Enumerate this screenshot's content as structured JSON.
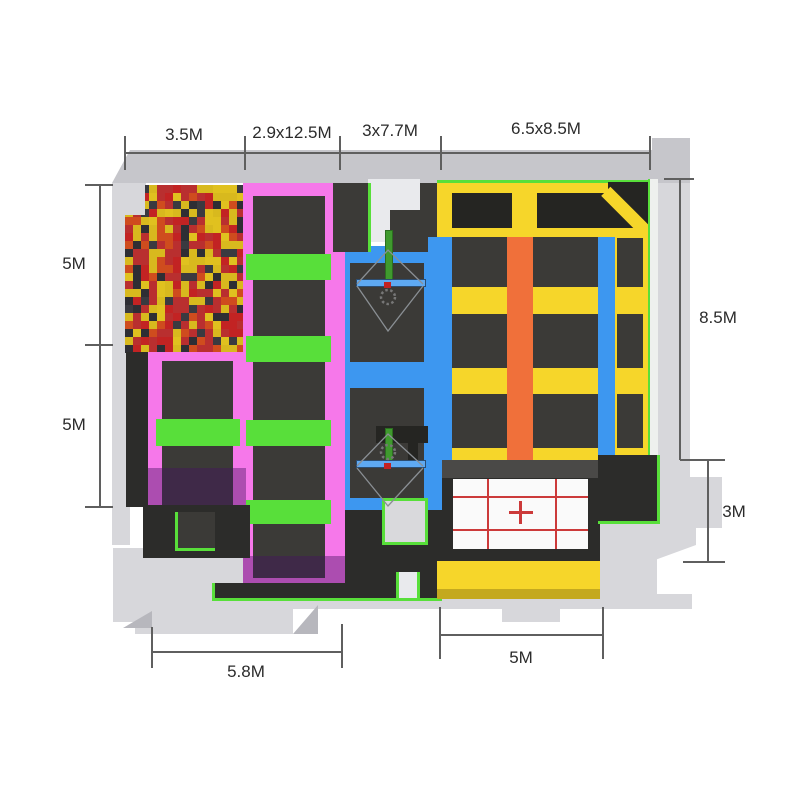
{
  "dims": {
    "top1": "3.5M",
    "top2": "2.9x12.5M",
    "top3": "3x7.7M",
    "top4": "6.5x8.5M",
    "left1": "5M",
    "left2": "5M",
    "right1": "8.5M",
    "right2": "3M",
    "bottom1": "5.8M",
    "bottom2": "5M"
  },
  "colors": {
    "pink": "#f678ea",
    "green": "#58df3a",
    "blue": "#3d97f0",
    "yellow": "#f6d62a",
    "orange": "#f0703a",
    "dark": "#3b3a37",
    "charcoal": "#2c2c2a",
    "wall": "#d7d7db",
    "wall_dark": "#c6c6cb",
    "court_white": "#fafafa",
    "court_red": "#cc3a3a",
    "walkway_face": "#c4a91f",
    "pad_gray": "#d9d9dc",
    "pole_green": "#3f9a2e",
    "purple_shadow": "rgba(70,20,95,0.42)"
  },
  "foam_pit": {
    "palette": [
      "#b92f2f",
      "#d8b91e",
      "#2e2e34",
      "#c22323",
      "#e0c11f",
      "#3a3a40",
      "#cf4c1e",
      "#b92f2f",
      "#d8b91e"
    ],
    "cols": 15,
    "rows": 21,
    "cell": 8,
    "seed": 7
  }
}
